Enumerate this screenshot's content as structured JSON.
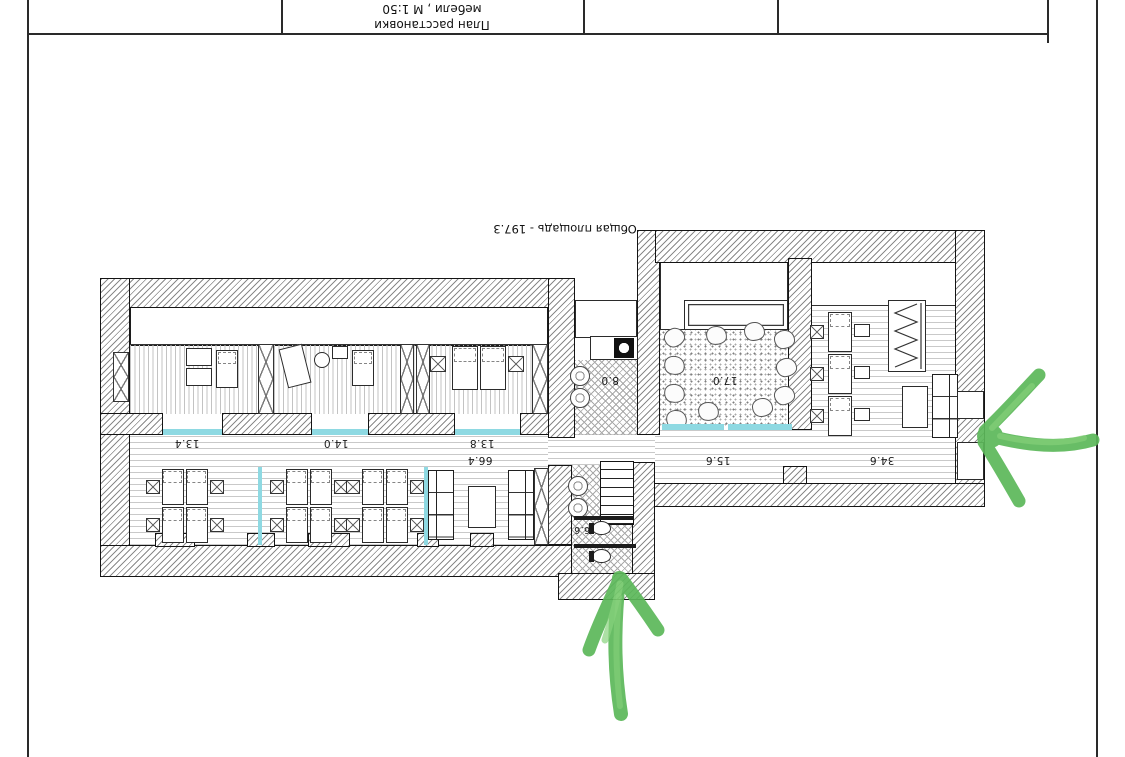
{
  "sheet": {
    "title_block": {
      "title_line1": "План расстановки",
      "title_line2": "мебели , М 1:50"
    },
    "annotations": {
      "total_area": "Общая площадь - 197.3"
    },
    "rooms": [
      {
        "name": "office-1",
        "area": "13.4"
      },
      {
        "name": "office-2",
        "area": "14.0"
      },
      {
        "name": "office-3",
        "area": "13.8"
      },
      {
        "name": "open-space",
        "area": "66.4"
      },
      {
        "name": "kitchen",
        "area": "8.0"
      },
      {
        "name": "lounge",
        "area": "17.0"
      },
      {
        "name": "hall",
        "area": "15.6"
      },
      {
        "name": "workzone",
        "area": "34.6"
      },
      {
        "name": "wc",
        "area": "6.6"
      }
    ],
    "colors": {
      "arrow_green": "#5cb85a",
      "door_threshold_cyan": "#8ed9e2",
      "wall_line": "#141414"
    }
  }
}
